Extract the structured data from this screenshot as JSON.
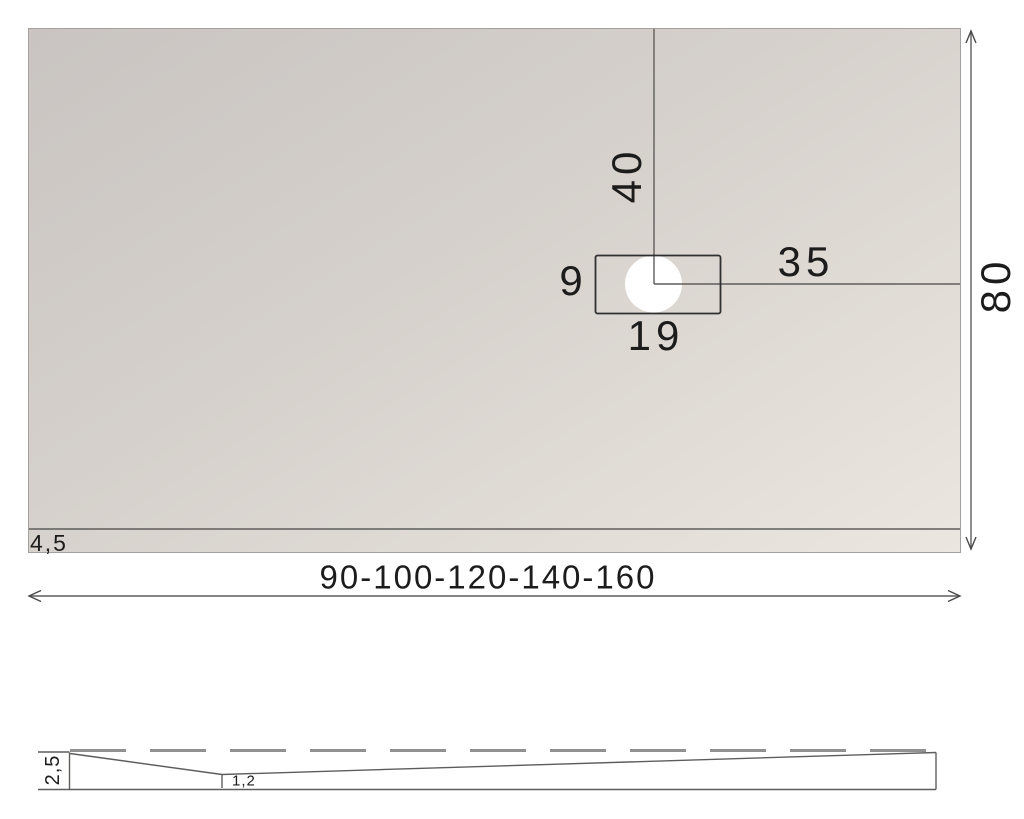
{
  "labels": {
    "drain_offset_top": "40",
    "drain_box_height": "9",
    "drain_offset_right": "35",
    "drain_box_width": "19",
    "tray_depth": "80",
    "edge_thickness": "4,5",
    "tray_widths": "90-100-120-140-160",
    "profile_edge_height": "2,5",
    "profile_min_thickness": "1,2"
  },
  "colors": {
    "tray-dark": "#c9c4c1",
    "tray-mid": "#d6d1cc",
    "tray-light": "#ebe6df",
    "line": "#4a4a4a",
    "edge": "#a3a09e",
    "dash": "#919191",
    "text": "#1c1c1c"
  }
}
